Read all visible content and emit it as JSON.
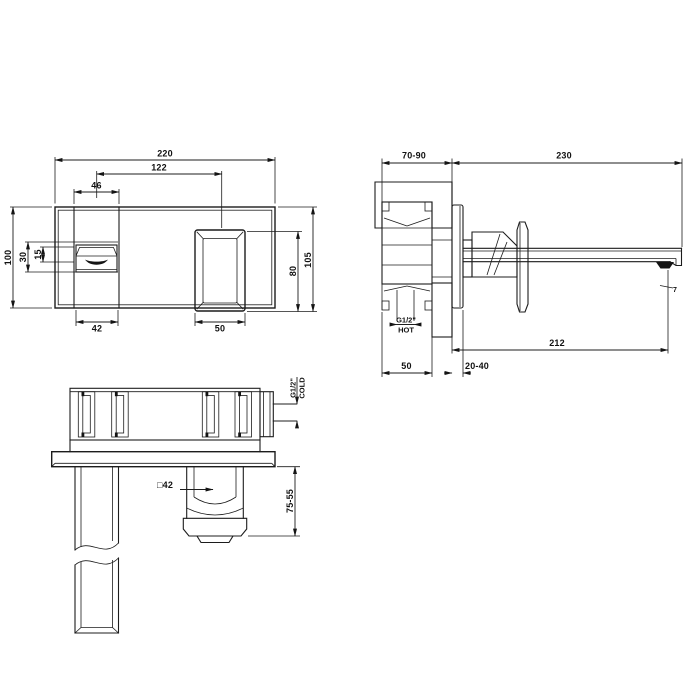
{
  "drawing_title": "wall-mounted basin mixer technical drawing",
  "front_view": {
    "dims": {
      "overall_width": "220",
      "spout_to_handle": "122",
      "spout_width": "46",
      "plate_height": "100",
      "spout_offset": "30",
      "spout_lip": "15",
      "spout_base_width": "42",
      "handle_width": "50",
      "handle_height": "80",
      "overall_height": "105"
    }
  },
  "side_view": {
    "dims": {
      "wall_depth_range": "70-90",
      "spout_projection": "230",
      "aerator_reach": "212",
      "aerator_detail": "7",
      "body_depth": "50",
      "plate_adjust_range": "20-40",
      "hot_inlet_thread": "G1/2\"",
      "hot_inlet_label": "HOT"
    }
  },
  "plan_view": {
    "dims": {
      "cold_inlet_thread": "G1/2\"",
      "cold_inlet_label": "COLD",
      "handle_section": "□42",
      "handle_projection_range": "75-55"
    }
  }
}
